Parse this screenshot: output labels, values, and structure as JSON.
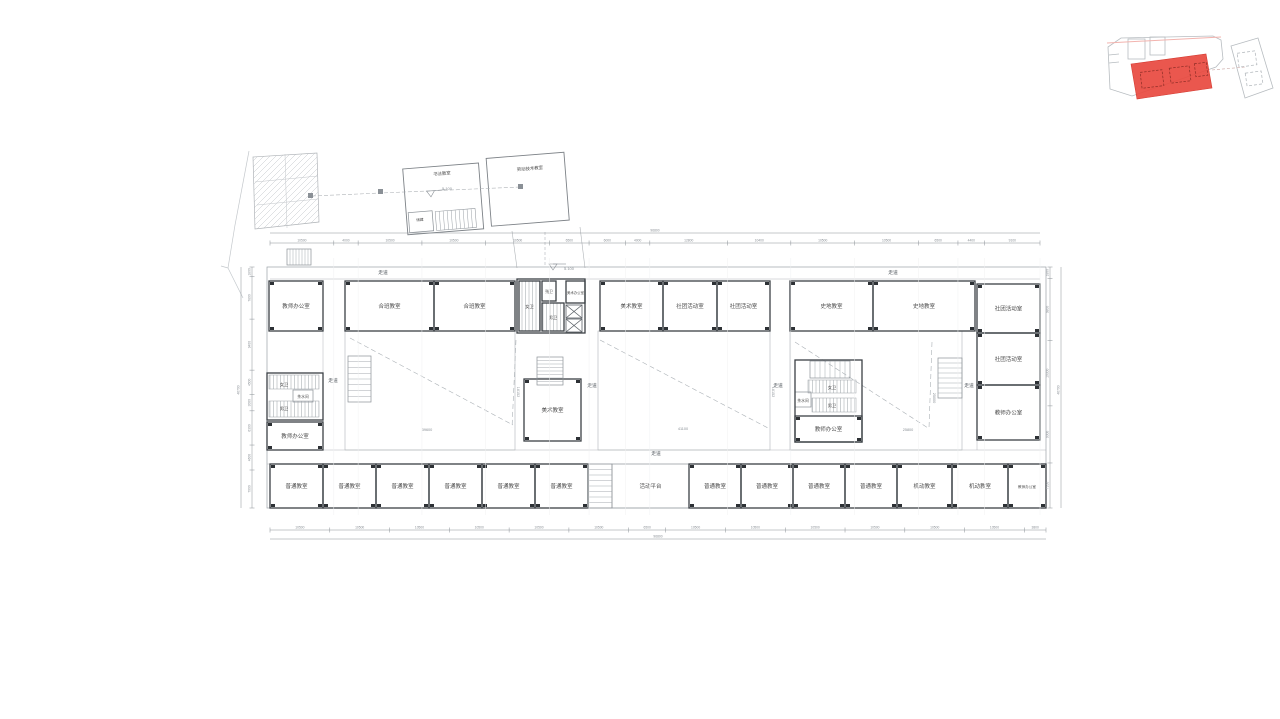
{
  "drawing": {
    "type": "architectural-floor-plan",
    "highlight_color": "#e8493f",
    "wall_color": "#3b4045",
    "dim_color": "#8a9096",
    "label_color": "#4a4a4a"
  },
  "floor_plan": {
    "rooms": [
      {
        "label": "教师办公室",
        "x": 269,
        "y": 281,
        "w": 54,
        "h": 50,
        "cs": 1
      },
      {
        "label": "合班教室",
        "x": 345,
        "y": 281,
        "w": 89,
        "h": 50,
        "cs": 1
      },
      {
        "label": "合班教室",
        "x": 434,
        "y": 281,
        "w": 81,
        "h": 50,
        "cs": 1
      },
      {
        "label": "美术教室",
        "x": 600,
        "y": 281,
        "w": 63,
        "h": 50,
        "cs": 1
      },
      {
        "label": "社团活动室",
        "x": 663,
        "y": 281,
        "w": 54,
        "h": 50,
        "cs": 1
      },
      {
        "label": "社团活动室",
        "x": 717,
        "y": 281,
        "w": 53,
        "h": 50,
        "cs": 1
      },
      {
        "label": "史地教室",
        "x": 790,
        "y": 281,
        "w": 83,
        "h": 50,
        "cs": 1
      },
      {
        "label": "史地教室",
        "x": 873,
        "y": 281,
        "w": 102,
        "h": 50,
        "cs": 1
      },
      {
        "label": "社团活动室",
        "x": 977,
        "y": 284,
        "w": 63,
        "h": 49,
        "cs": 1
      },
      {
        "label": "社团活动室",
        "x": 977,
        "y": 333,
        "w": 63,
        "h": 52,
        "cs": 1
      },
      {
        "label": "教师办公室",
        "x": 977,
        "y": 385,
        "w": 63,
        "h": 55,
        "cs": 1
      },
      {
        "label": "",
        "x": 517,
        "y": 279,
        "w": 68,
        "h": 54
      },
      {
        "label": "女卫",
        "x": 519,
        "y": 281,
        "w": 21,
        "h": 50,
        "fs": 4.2,
        "stall": 1
      },
      {
        "label": "残卫",
        "x": 542,
        "y": 281,
        "w": 14,
        "h": 20,
        "fs": 3.8
      },
      {
        "label": "男卫",
        "x": 542,
        "y": 303,
        "w": 22,
        "h": 28,
        "fs": 4.2,
        "stall": 1
      },
      {
        "label": "美术办公室",
        "x": 566,
        "y": 281,
        "w": 19,
        "h": 22,
        "fs": 3.4
      },
      {
        "label": "美术教室",
        "x": 524,
        "y": 379,
        "w": 57,
        "h": 62,
        "cs": 1
      },
      {
        "label": "",
        "x": 267,
        "y": 373,
        "w": 56,
        "h": 47
      },
      {
        "label": "教师办公室",
        "x": 267,
        "y": 422,
        "w": 56,
        "h": 28,
        "cs": 1
      },
      {
        "label": "",
        "x": 795,
        "y": 360,
        "w": 67,
        "h": 82
      },
      {
        "label": "教师办公室",
        "x": 795,
        "y": 416,
        "w": 67,
        "h": 26,
        "cs": 1
      },
      {
        "label": "普通教室",
        "x": 270,
        "y": 464,
        "w": 53,
        "h": 44,
        "cs": 1
      },
      {
        "label": "普通教室",
        "x": 323,
        "y": 464,
        "w": 53,
        "h": 44,
        "cs": 1
      },
      {
        "label": "普通教室",
        "x": 376,
        "y": 464,
        "w": 53,
        "h": 44,
        "cs": 1
      },
      {
        "label": "普通教室",
        "x": 429,
        "y": 464,
        "w": 53,
        "h": 44,
        "cs": 1
      },
      {
        "label": "普通教室",
        "x": 482,
        "y": 464,
        "w": 53,
        "h": 44,
        "cs": 1
      },
      {
        "label": "普通教室",
        "x": 535,
        "y": 464,
        "w": 53,
        "h": 44,
        "cs": 1
      },
      {
        "label": "活动平台",
        "x": 612,
        "y": 464,
        "w": 77,
        "h": 44,
        "light": 1
      },
      {
        "label": "普通教室",
        "x": 689,
        "y": 464,
        "w": 52,
        "h": 44,
        "cs": 1
      },
      {
        "label": "普通教室",
        "x": 741,
        "y": 464,
        "w": 52,
        "h": 44,
        "cs": 1
      },
      {
        "label": "普通教室",
        "x": 793,
        "y": 464,
        "w": 52,
        "h": 44,
        "cs": 1
      },
      {
        "label": "普通教室",
        "x": 845,
        "y": 464,
        "w": 52,
        "h": 44,
        "cs": 1
      },
      {
        "label": "机动教室",
        "x": 897,
        "y": 464,
        "w": 55,
        "h": 44,
        "cs": 1
      },
      {
        "label": "机动教室",
        "x": 952,
        "y": 464,
        "w": 56,
        "h": 44,
        "cs": 1
      },
      {
        "label": "教师办公室",
        "x": 1008,
        "y": 464,
        "w": 38,
        "h": 44,
        "fs": 3.6,
        "cs": 1
      }
    ],
    "small_labels": [
      {
        "text": "女卫",
        "x": 284,
        "y": 386,
        "fs": 4.2
      },
      {
        "text": "茶水间",
        "x": 303,
        "y": 398,
        "fs": 3.8
      },
      {
        "text": "男卫",
        "x": 284,
        "y": 410,
        "fs": 4.2
      },
      {
        "text": "女卫",
        "x": 832,
        "y": 389,
        "fs": 4.2
      },
      {
        "text": "茶水间",
        "x": 803,
        "y": 402,
        "fs": 3.8
      },
      {
        "text": "男卫",
        "x": 832,
        "y": 407,
        "fs": 4.2
      }
    ],
    "corridor_labels": [
      {
        "text": "走道",
        "x": 383,
        "y": 274
      },
      {
        "text": "走道",
        "x": 893,
        "y": 274
      },
      {
        "text": "走道",
        "x": 333,
        "y": 382
      },
      {
        "text": "走道",
        "x": 592,
        "y": 387
      },
      {
        "text": "走道",
        "x": 778,
        "y": 387
      },
      {
        "text": "走道",
        "x": 969,
        "y": 387
      },
      {
        "text": "走道",
        "x": 656,
        "y": 455
      }
    ],
    "annex_labels": [
      {
        "text": "书法教室",
        "x": 442,
        "y": 175,
        "fs": 4.4,
        "rot": -4.5
      },
      {
        "text": "劳动技术教室",
        "x": 530,
        "y": 170,
        "fs": 4.4,
        "rot": -4.5
      },
      {
        "text": "储藏",
        "x": 420,
        "y": 221,
        "fs": 3.6,
        "rot": -4.5
      }
    ],
    "elevation_marks": [
      {
        "text": "5.100",
        "x": 563,
        "y": 270
      },
      {
        "text": "5.100",
        "x": 441,
        "y": 190
      }
    ],
    "area_dims": [
      {
        "text": "39600",
        "x": 427,
        "y": 431
      },
      {
        "text": "41100",
        "x": 683,
        "y": 430
      },
      {
        "text": "25800",
        "x": 908,
        "y": 431
      },
      {
        "text": "16152",
        "x": 517,
        "y": 392,
        "rot": 90
      },
      {
        "text": "16152",
        "x": 772,
        "y": 392,
        "rot": 90
      },
      {
        "text": "25000",
        "x": 933,
        "y": 398,
        "rot": 90
      }
    ],
    "dims": {
      "top": {
        "values": [
          "10500",
          "4000",
          "10500",
          "10500",
          "10500",
          "6500",
          "6000",
          "4000",
          "12800",
          "10400",
          "10500",
          "10500",
          "6500",
          "4400",
          "9100"
        ]
      },
      "top_total": "96800",
      "bottom": {
        "values": [
          "10500",
          "10500",
          "10500",
          "10500",
          "10500",
          "10500",
          "6500",
          "10500",
          "10500",
          "10500",
          "10500",
          "10500",
          "10500",
          "3800"
        ]
      },
      "bottom_total": "96800",
      "left": {
        "values": [
          "1800",
          "7800",
          "9400",
          "4500",
          "3000",
          "6300",
          "4600",
          "7000"
        ]
      },
      "left_total": "46700",
      "right": {
        "values": [
          "1800",
          "9800",
          "10300",
          "9000",
          "7100"
        ]
      },
      "right_total": "46700"
    }
  },
  "key_plan": {
    "highlighted_block": "current-building",
    "highlight_color": "#e8493f"
  }
}
